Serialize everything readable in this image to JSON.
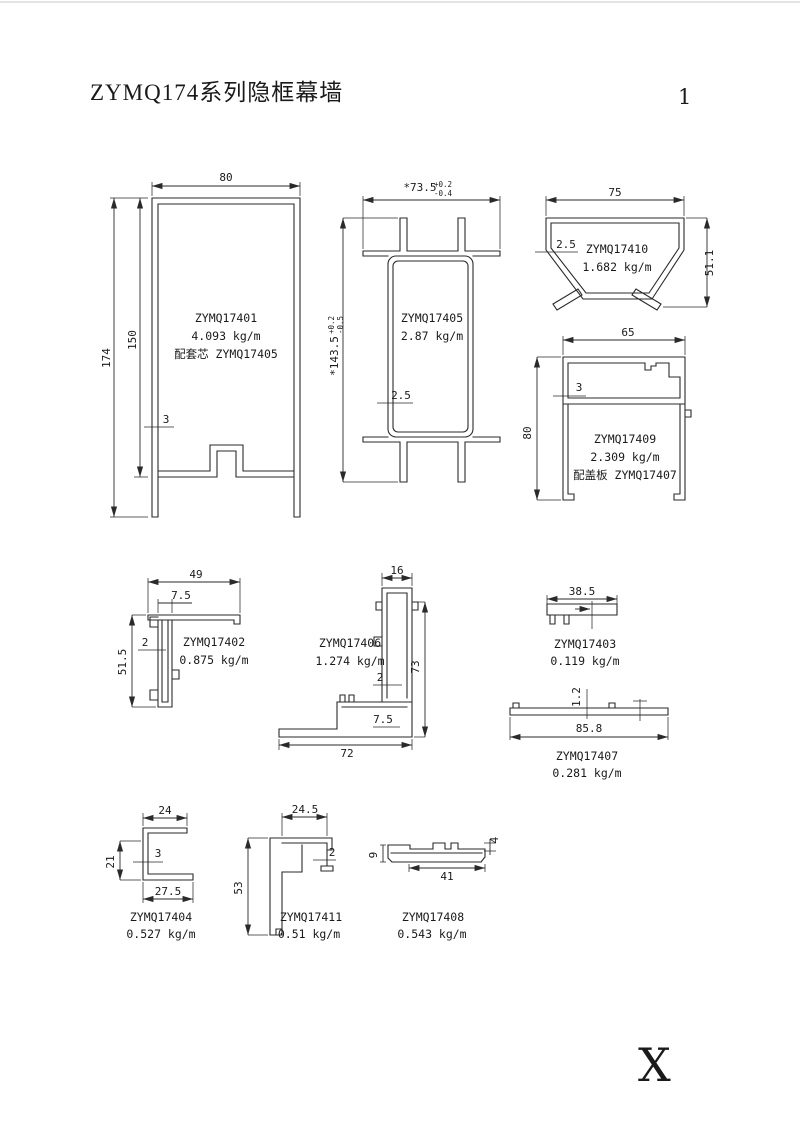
{
  "page": {
    "title": "ZYMQ174系列隐框幕墙",
    "page_number": "1",
    "corner_mark": "X"
  },
  "colors": {
    "line": "#2a2a2a",
    "text": "#1a1a1a",
    "background": "#ffffff"
  },
  "profiles": {
    "p17401": {
      "code": "ZYMQ17401",
      "weight": "4.093 kg/m",
      "note": "配套芯 ZYMQ17405",
      "dim_width": "80",
      "dim_height": "174",
      "dim_inner_height": "150",
      "dim_wall": "3"
    },
    "p17405": {
      "code": "ZYMQ17405",
      "weight": "2.87 kg/m",
      "dim_width": "*73.5",
      "dim_width_tol_up": "+0.2",
      "dim_width_tol_dn": "-0.4",
      "dim_height": "*143.5",
      "dim_height_tol_up": "+0.2",
      "dim_height_tol_dn": "-0.5",
      "dim_wall": "2.5"
    },
    "p17410": {
      "code": "ZYMQ17410",
      "weight": "1.682 kg/m",
      "dim_width": "75",
      "dim_height": "51.1",
      "dim_wall": "2.5"
    },
    "p17409": {
      "code": "ZYMQ17409",
      "weight": "2.309 kg/m",
      "note": "配盖板 ZYMQ17407",
      "dim_width": "65",
      "dim_height": "80",
      "dim_wall": "3"
    },
    "p17402": {
      "code": "ZYMQ17402",
      "weight": "0.875 kg/m",
      "dim_width": "49",
      "dim_arm": "7.5",
      "dim_height": "51.5",
      "dim_wall": "2"
    },
    "p17406": {
      "code": "ZYMQ17406",
      "weight": "1.274 kg/m",
      "dim_top": "16",
      "dim_height": "73",
      "dim_base": "72",
      "dim_wall": "2",
      "dim_step": "7.5"
    },
    "p17403": {
      "code": "ZYMQ17403",
      "weight": "0.119 kg/m",
      "dim_width": "38.5"
    },
    "p17407": {
      "code": "ZYMQ17407",
      "weight": "0.281 kg/m",
      "dim_width": "85.8",
      "dim_wall": "1.2"
    },
    "p17404": {
      "code": "ZYMQ17404",
      "weight": "0.527 kg/m",
      "dim_top": "24",
      "dim_height": "21",
      "dim_wall": "3",
      "dim_bottom": "27.5"
    },
    "p17411": {
      "code": "ZYMQ17411",
      "weight": "0.51 kg/m",
      "dim_top": "24.5",
      "dim_height": "53",
      "dim_wall": "2"
    },
    "p17408": {
      "code": "ZYMQ17408",
      "weight": "0.543 kg/m",
      "dim_bottom": "41",
      "dim_left": "9",
      "dim_right": "4"
    }
  }
}
